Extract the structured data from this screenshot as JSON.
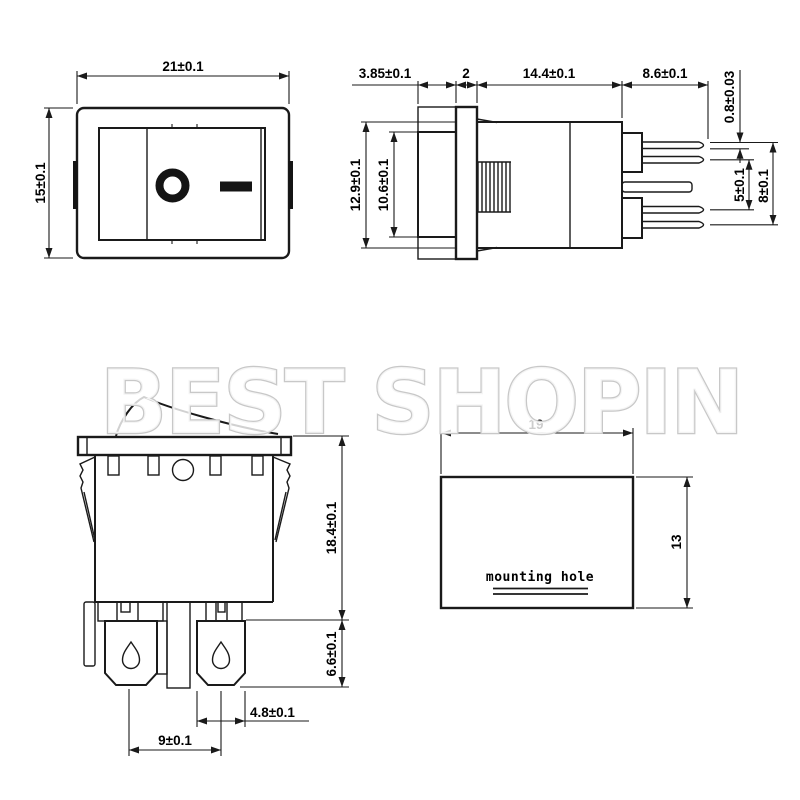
{
  "watermark": {
    "text": "BEST SHOPIN",
    "outline_color": "#c8c8c8",
    "fill_color": "#ffffff"
  },
  "drawing": {
    "line_color": "#1a1a1a",
    "text_color": "#000000",
    "background": "#ffffff"
  },
  "dims": {
    "front_width": "21±0.1",
    "front_height": "15±0.1",
    "rocker_depth": "3.85±0.1",
    "flange_thickness": "2",
    "body_depth": "14.4±0.1",
    "pin_length": "8.6±0.1",
    "pin_thickness": "0.8±0.03",
    "body_height": "12.9±0.1",
    "rocker_height": "10.6±0.1",
    "pin_gap": "5±0.1",
    "pin_span": "8±0.1",
    "mounted_height": "18.4±0.1",
    "terminal_length": "6.6±0.1",
    "terminal_width": "4.8±0.1",
    "terminal_pitch": "9±0.1",
    "hole_width": "19",
    "hole_height": "13"
  },
  "labels": {
    "mounting_hole": "mounting hole"
  },
  "symbols": {
    "on": "—",
    "off": "O"
  }
}
